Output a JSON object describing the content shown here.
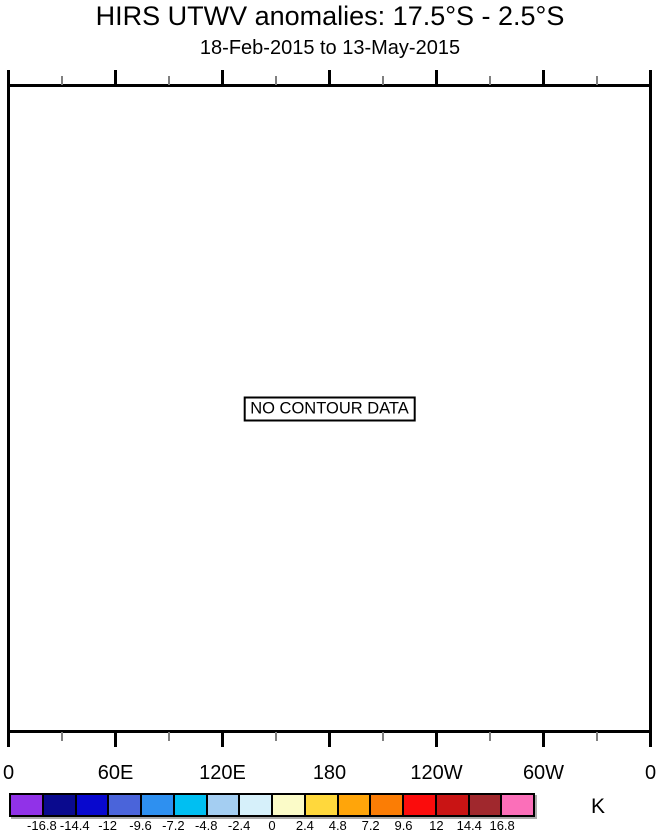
{
  "chart_data": {
    "type": "heatmap",
    "title": "HIRS UTWV anomalies: 17.5°S - 2.5°S",
    "subtitle": "18-Feb-2015 to 13-May-2015",
    "annotation": "NO CONTOUR DATA",
    "values": [],
    "x_axis": {
      "range_deg": [
        0,
        360
      ],
      "major_ticks_deg": [
        0,
        60,
        120,
        180,
        240,
        300,
        360
      ],
      "major_tick_labels": [
        "0",
        "60E",
        "120E",
        "180",
        "120W",
        "60W",
        "0"
      ],
      "minor_ticks_deg": [
        30,
        90,
        150,
        210,
        270,
        330
      ],
      "minor_tick_color": "#808080",
      "major_tick_color": "#000000"
    },
    "colorbar": {
      "unit": "K",
      "levels": [
        -16.8,
        -14.4,
        -12,
        -9.6,
        -7.2,
        -4.8,
        -2.4,
        0,
        2.4,
        4.8,
        7.2,
        9.6,
        12,
        14.4,
        16.8
      ],
      "level_labels": [
        "-16.8",
        "-14.4",
        "-12",
        "-9.6",
        "-7.2",
        "-4.8",
        "-2.4",
        "0",
        "2.4",
        "4.8",
        "7.2",
        "9.6",
        "12",
        "14.4",
        "16.8"
      ],
      "colors": [
        "#9132E8",
        "#0A0A8E",
        "#0808CE",
        "#4A64DA",
        "#2E90F0",
        "#00BFF2",
        "#A4CEF2",
        "#D6F0FA",
        "#FBFBC8",
        "#FFD83C",
        "#FFA50A",
        "#FB7D05",
        "#FB0C0C",
        "#C91414",
        "#A0282D",
        "#FB6FB9"
      ]
    }
  }
}
